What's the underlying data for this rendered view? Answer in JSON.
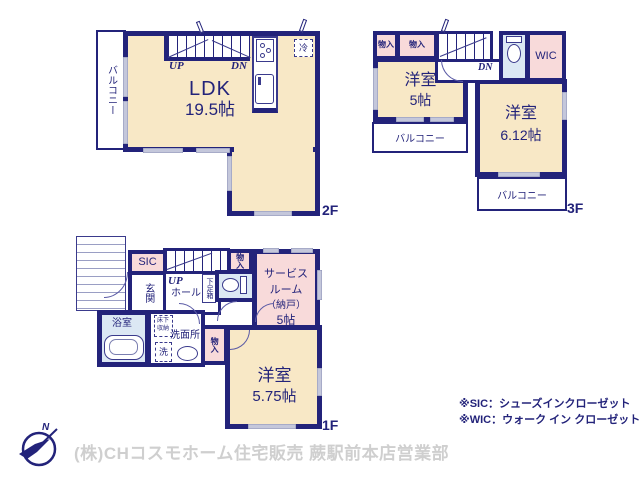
{
  "colors": {
    "wall_navy": "#23237A",
    "room_cream": "#F8E8C6",
    "closet_pink": "#F8DADA",
    "wet_area_blue": "#DCE8F4",
    "window_gray": "#C4C7DB",
    "footer_gray": "#CFCFCF"
  },
  "floor2": {
    "floor_label": "2F",
    "balcony": "バルコニー",
    "ldk_name": "LDK",
    "ldk_size": "19.5帖",
    "up": "UP",
    "dn": "DN",
    "fridge": "冷"
  },
  "floor3": {
    "floor_label": "3F",
    "closet1": "物入",
    "closet2": "物入",
    "dn": "DN",
    "wic": "WIC",
    "room1_name": "洋室",
    "room1_size": "5帖",
    "room2_name": "洋室",
    "room2_size": "6.12帖",
    "balcony1": "バルコニー",
    "balcony2": "バルコニー"
  },
  "floor1": {
    "floor_label": "1F",
    "sic": "SIC",
    "genkan": "玄関",
    "up": "UP",
    "hall": "ホール",
    "shoebox": "下足箱",
    "closet_top": "物入",
    "service_line1": "サービス",
    "service_line2": "ルーム",
    "service_line3": "（納戸）",
    "service_line4": "5帖",
    "bath": "浴室",
    "underfloor_line1": "床下",
    "underfloor_line2": "収納",
    "washroom": "洗面所",
    "laundry": "洗",
    "closet_bottom": "物入",
    "room_name": "洋室",
    "room_size": "5.75帖"
  },
  "notes": {
    "sic": "※SIC：シューズインクローゼット",
    "wic": "※WIC：ウォーク イン クローゼット"
  },
  "footer": {
    "company": "(株)CHコスモホーム住宅販売 蕨駅前本店営業部",
    "compass_n": "N"
  }
}
